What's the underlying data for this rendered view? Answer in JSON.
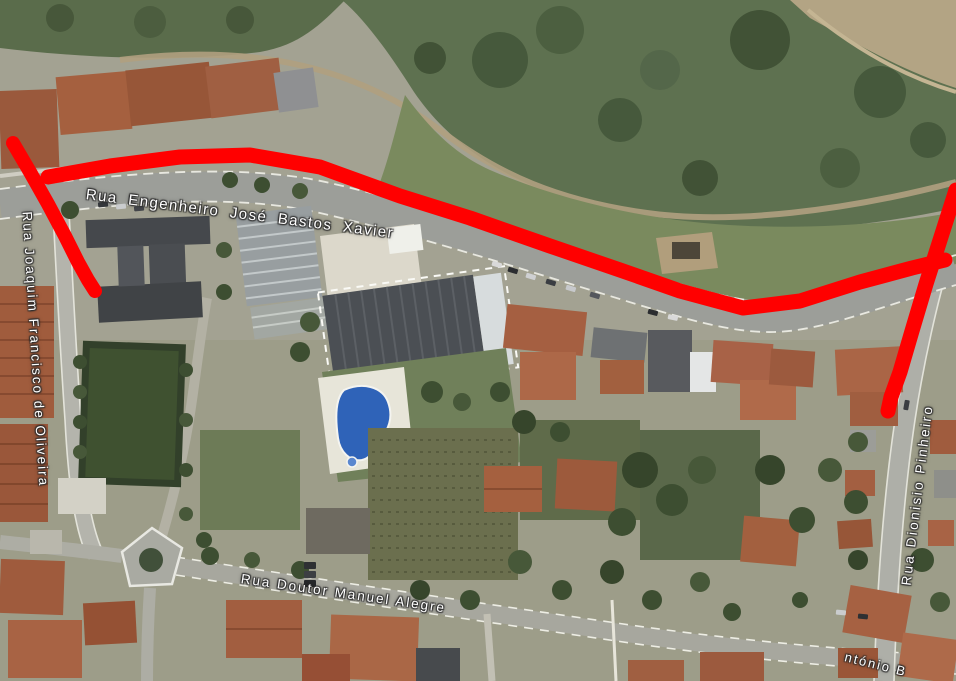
{
  "map": {
    "kind": "satellite-aerial-view",
    "palette": {
      "annotation_red": "#ff0000",
      "pool_blue": "#2f63b8",
      "field_green": "#3f5130",
      "hill_green": "#5e7150",
      "roof_orange": "#a5603f",
      "road_gray": "#9c9e99"
    },
    "street_labels": [
      {
        "id": "rua-engenheiro-jose-bastos-xavier",
        "text": "Rua Engenheiro José Bastos Xavier",
        "x": 86,
        "y": 186,
        "angle": 7.2,
        "font_size": 15,
        "letter_spacing": 1.5,
        "word_spacing": 5
      },
      {
        "id": "rua-joaquim-francisco-de-oliveira",
        "text": "Rua Joaquim Francisco de Oliveira",
        "x": 27,
        "y": 204,
        "angle": 86.5,
        "font_size": 13.5,
        "letter_spacing": 2
      },
      {
        "id": "rua-dionisio-pinheiro",
        "text": "Rua Dionisio Pinheiro",
        "x": 906,
        "y": 578,
        "angle": -83,
        "font_size": 13.5,
        "letter_spacing": 2.5
      },
      {
        "id": "rua-doutor-manuel-alegre",
        "text": "Rua Doutor Manuel Alegre",
        "x": 241,
        "y": 571,
        "angle": 8.2,
        "font_size": 13.5,
        "letter_spacing": 2
      },
      {
        "id": "rua-antonio-b-partial",
        "text": "ntónio B",
        "x": 845,
        "y": 649,
        "angle": 14,
        "font_size": 13,
        "letter_spacing": 2
      }
    ],
    "routes": [
      {
        "name": "route-rua-engenheiro-jose-bastos-xavier",
        "color": "#ff0000",
        "width": 15,
        "points": [
          [
            48,
            177
          ],
          [
            110,
            166
          ],
          [
            180,
            157
          ],
          [
            250,
            155
          ],
          [
            320,
            167
          ],
          [
            400,
            196
          ],
          [
            470,
            218
          ],
          [
            550,
            246
          ],
          [
            620,
            270
          ],
          [
            680,
            291
          ],
          [
            743,
            308
          ],
          [
            800,
            301
          ],
          [
            860,
            282
          ],
          [
            912,
            268
          ],
          [
            945,
            260
          ]
        ]
      },
      {
        "name": "route-rua-joaquim-francisco-de-oliveira",
        "color": "#ff0000",
        "width": 14,
        "points": [
          [
            13,
            143
          ],
          [
            30,
            172
          ],
          [
            48,
            204
          ],
          [
            65,
            236
          ],
          [
            78,
            262
          ],
          [
            88,
            280
          ],
          [
            95,
            291
          ]
        ]
      },
      {
        "name": "route-rua-dionisio-pinheiro",
        "color": "#ff0000",
        "width": 15,
        "points": [
          [
            956,
            190
          ],
          [
            941,
            237
          ],
          [
            926,
            284
          ],
          [
            912,
            331
          ],
          [
            900,
            372
          ],
          [
            891,
            397
          ],
          [
            888,
            411
          ]
        ]
      }
    ]
  }
}
